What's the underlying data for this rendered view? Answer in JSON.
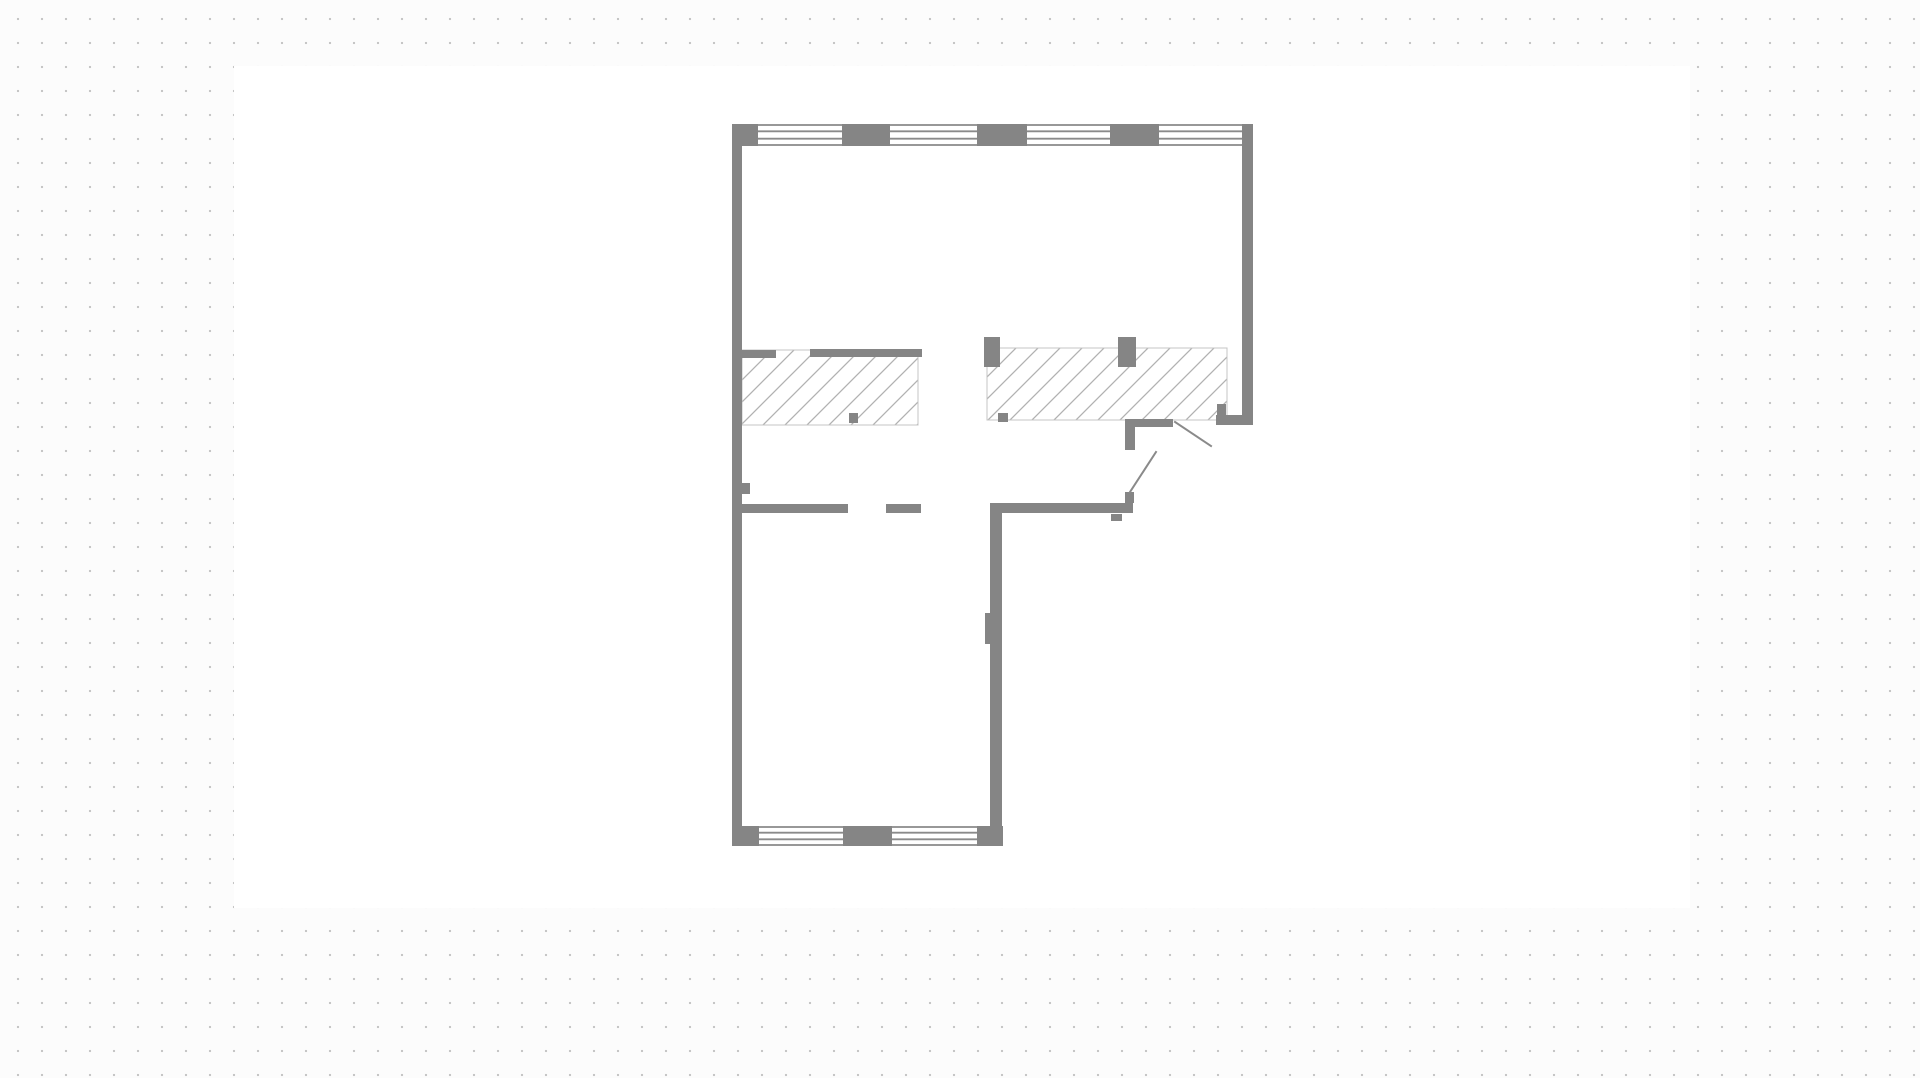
{
  "app": {
    "view": "floor-plan-canvas",
    "visible_text": ""
  },
  "palette": {
    "page_background": "#fcfcfc",
    "grid_dot": "#c6c6c6",
    "artboard_background": "#ffffff",
    "wall": "#858585",
    "window_line": "#8a8a8a",
    "hatch_line": "#b1b1b1",
    "hatch_border": "#c4c4c4",
    "door_leaf": "#8a8a8a"
  },
  "grid": {
    "pitch_px": 24,
    "dot_size_px": 2,
    "offset_x": 6,
    "offset_y": 7
  },
  "artboard": {
    "x": 234,
    "y": 66,
    "width": 1456,
    "height": 842
  },
  "floorplan": {
    "bounds": {
      "left": 732,
      "top": 124,
      "right": 1253,
      "bottom": 846
    },
    "hatches": [
      {
        "name": "hatch-area-left",
        "x": 742,
        "y": 350,
        "w": 176,
        "h": 75
      },
      {
        "name": "hatch-area-right",
        "x": 987,
        "y": 348,
        "w": 240,
        "h": 72
      }
    ],
    "windows": [
      {
        "name": "window-top-1",
        "x": 758,
        "y": 124,
        "w": 84,
        "h": 22
      },
      {
        "name": "window-top-2",
        "x": 890,
        "y": 124,
        "w": 87,
        "h": 22
      },
      {
        "name": "window-top-3",
        "x": 1027,
        "y": 124,
        "w": 83,
        "h": 22
      },
      {
        "name": "window-top-4",
        "x": 1159,
        "y": 124,
        "w": 83,
        "h": 22
      },
      {
        "name": "window-bottom-1",
        "x": 759,
        "y": 826,
        "w": 84,
        "h": 20
      },
      {
        "name": "window-bottom-2",
        "x": 892,
        "y": 826,
        "w": 85,
        "h": 20
      }
    ],
    "walls": [
      {
        "name": "top-left-corner-block",
        "x": 732,
        "y": 124,
        "w": 26,
        "h": 22
      },
      {
        "name": "top-wall-block-1",
        "x": 842,
        "y": 124,
        "w": 48,
        "h": 22
      },
      {
        "name": "top-wall-block-2",
        "x": 977,
        "y": 124,
        "w": 50,
        "h": 22
      },
      {
        "name": "top-wall-block-3",
        "x": 1110,
        "y": 124,
        "w": 49,
        "h": 22
      },
      {
        "name": "left-exterior-wall",
        "x": 732,
        "y": 124,
        "w": 10,
        "h": 721
      },
      {
        "name": "right-exterior-wall",
        "x": 1242,
        "y": 124,
        "w": 11,
        "h": 291
      },
      {
        "name": "right-wall-foot",
        "x": 1216,
        "y": 415,
        "w": 37,
        "h": 10
      },
      {
        "name": "jamb-block-right",
        "x": 1217,
        "y": 404,
        "w": 9,
        "h": 11
      },
      {
        "name": "mid-wall-right",
        "x": 990,
        "y": 503,
        "w": 143,
        "h": 10
      },
      {
        "name": "lower-right-wall",
        "x": 990,
        "y": 503,
        "w": 12,
        "h": 343
      },
      {
        "name": "door-jamb-lower-wall",
        "x": 985,
        "y": 613,
        "w": 5,
        "h": 31
      },
      {
        "name": "door-hinge-stub",
        "x": 1125,
        "y": 492,
        "w": 9,
        "h": 11
      },
      {
        "name": "jamb-block-mid-wall",
        "x": 1111,
        "y": 514,
        "w": 11,
        "h": 7
      },
      {
        "name": "door-frame-horizontal",
        "x": 1125,
        "y": 419,
        "w": 48,
        "h": 8
      },
      {
        "name": "door-frame-vertical",
        "x": 1125,
        "y": 419,
        "w": 10,
        "h": 31
      },
      {
        "name": "mid-wall-left",
        "x": 742,
        "y": 504,
        "w": 106,
        "h": 9
      },
      {
        "name": "mid-wall-dash",
        "x": 886,
        "y": 504,
        "w": 35,
        "h": 9
      },
      {
        "name": "door-jamb-left-wall",
        "x": 742,
        "y": 483,
        "w": 8,
        "h": 11
      },
      {
        "name": "hatch-left-top-wall-1",
        "x": 742,
        "y": 350,
        "w": 34,
        "h": 8
      },
      {
        "name": "hatch-left-top-wall-2",
        "x": 810,
        "y": 349,
        "w": 112,
        "h": 8
      },
      {
        "name": "bottom-left-corner-block",
        "x": 732,
        "y": 826,
        "w": 27,
        "h": 20
      },
      {
        "name": "bottom-wall-block",
        "x": 843,
        "y": 826,
        "w": 49,
        "h": 20
      },
      {
        "name": "bottom-right-corner-block",
        "x": 977,
        "y": 826,
        "w": 26,
        "h": 20
      },
      {
        "name": "hatch-right-pier-1",
        "x": 984,
        "y": 337,
        "w": 16,
        "h": 30
      },
      {
        "name": "hatch-right-pier-2",
        "x": 1118,
        "y": 337,
        "w": 18,
        "h": 30
      },
      {
        "name": "hatch-left-square",
        "x": 849,
        "y": 413,
        "w": 9,
        "h": 10
      },
      {
        "name": "hatch-right-square",
        "x": 998,
        "y": 413,
        "w": 10,
        "h": 9
      }
    ],
    "door_leaves": [
      {
        "name": "door-leaf-right",
        "x1": 1175,
        "y1": 422,
        "x2": 1211,
        "y2": 446
      },
      {
        "name": "door-leaf-left",
        "x1": 1156,
        "y1": 452,
        "x2": 1130,
        "y2": 492
      }
    ]
  }
}
